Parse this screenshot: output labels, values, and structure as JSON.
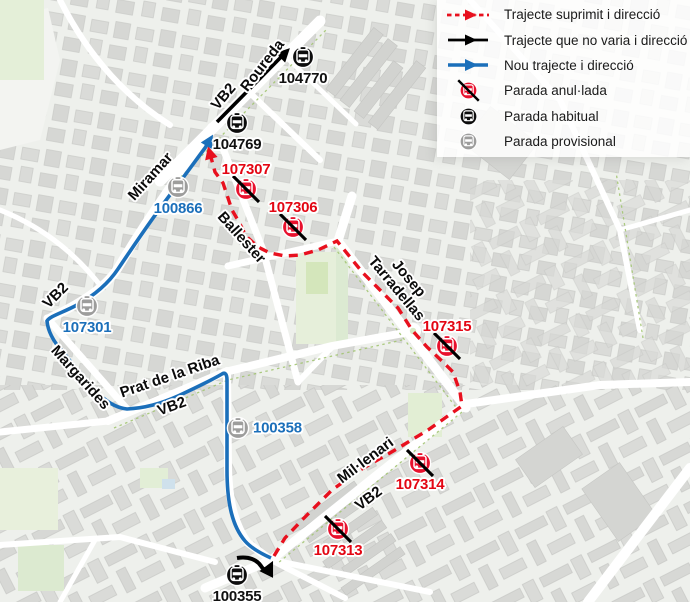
{
  "legend": {
    "items": [
      {
        "label": "Trajecte suprimit i direcció",
        "swatch": "route-suppressed-arrow"
      },
      {
        "label": "Trajecte que no varia i direcció",
        "swatch": "route-unchanged-arrow"
      },
      {
        "label": "Nou trajecte i direcció",
        "swatch": "route-new-arrow"
      },
      {
        "label": "Parada anul·lada",
        "swatch": "stop-cancelled-icon"
      },
      {
        "label": "Parada habitual",
        "swatch": "stop-regular-icon"
      },
      {
        "label": "Parada provisional",
        "swatch": "stop-provisional-icon"
      }
    ]
  },
  "colors": {
    "route_suppressed": "#e8101e",
    "route_unchanged": "#000000",
    "route_new": "#1b6fba",
    "stop_cancelled": "#e8112d",
    "stop_regular": "#0d0d0d",
    "stop_provisional": "#9d9d9c",
    "label_red": "#e30613",
    "label_blue": "#1b6fba",
    "label_black": "#111111"
  },
  "bus_line": "VB2",
  "stops": [
    {
      "id": "104770",
      "kind": "regular",
      "x": 303,
      "y": 57,
      "label_pos": "below",
      "label_color": "black"
    },
    {
      "id": "104769",
      "kind": "regular",
      "x": 237,
      "y": 123,
      "label_pos": "below",
      "label_color": "black"
    },
    {
      "id": "107307",
      "kind": "cancelled",
      "x": 246,
      "y": 189,
      "label_pos": "above",
      "label_color": "red"
    },
    {
      "id": "107306",
      "kind": "cancelled",
      "x": 293,
      "y": 227,
      "label_pos": "above",
      "label_color": "red"
    },
    {
      "id": "100866",
      "kind": "provisional",
      "x": 178,
      "y": 187,
      "label_pos": "below",
      "label_color": "blue"
    },
    {
      "id": "107301",
      "kind": "provisional",
      "x": 87,
      "y": 306,
      "label_pos": "below",
      "label_color": "blue"
    },
    {
      "id": "107315",
      "kind": "cancelled",
      "x": 447,
      "y": 346,
      "label_pos": "above",
      "label_color": "red"
    },
    {
      "id": "100358",
      "kind": "provisional",
      "x": 238,
      "y": 428,
      "label_pos": "right",
      "label_color": "blue"
    },
    {
      "id": "107314",
      "kind": "cancelled",
      "x": 420,
      "y": 463,
      "label_pos": "below",
      "label_color": "red"
    },
    {
      "id": "107313",
      "kind": "cancelled",
      "x": 338,
      "y": 529,
      "label_pos": "below",
      "label_color": "red"
    },
    {
      "id": "100355",
      "kind": "regular",
      "x": 237,
      "y": 575,
      "label_pos": "below",
      "label_color": "black"
    }
  ],
  "street_labels": [
    {
      "text": "Roureda",
      "x": 263,
      "y": 66,
      "angle": -52
    },
    {
      "text": "VB2",
      "x": 224,
      "y": 97,
      "angle": -50
    },
    {
      "text": "Miramar",
      "x": 151,
      "y": 177,
      "angle": -48
    },
    {
      "text": "Ballester",
      "x": 241,
      "y": 238,
      "angle": 48
    },
    {
      "text": "Josep\nTarradellas",
      "x": 402,
      "y": 284,
      "angle": 50
    },
    {
      "text": "VB2",
      "x": 56,
      "y": 296,
      "angle": -45
    },
    {
      "text": "Margarides",
      "x": 80,
      "y": 378,
      "angle": 48
    },
    {
      "text": "Prat de la Riba",
      "x": 170,
      "y": 377,
      "angle": -19
    },
    {
      "text": "VB2",
      "x": 172,
      "y": 407,
      "angle": -20
    },
    {
      "text": "Mil·lenari",
      "x": 366,
      "y": 461,
      "angle": -37
    },
    {
      "text": "VB2",
      "x": 369,
      "y": 499,
      "angle": -37
    }
  ]
}
